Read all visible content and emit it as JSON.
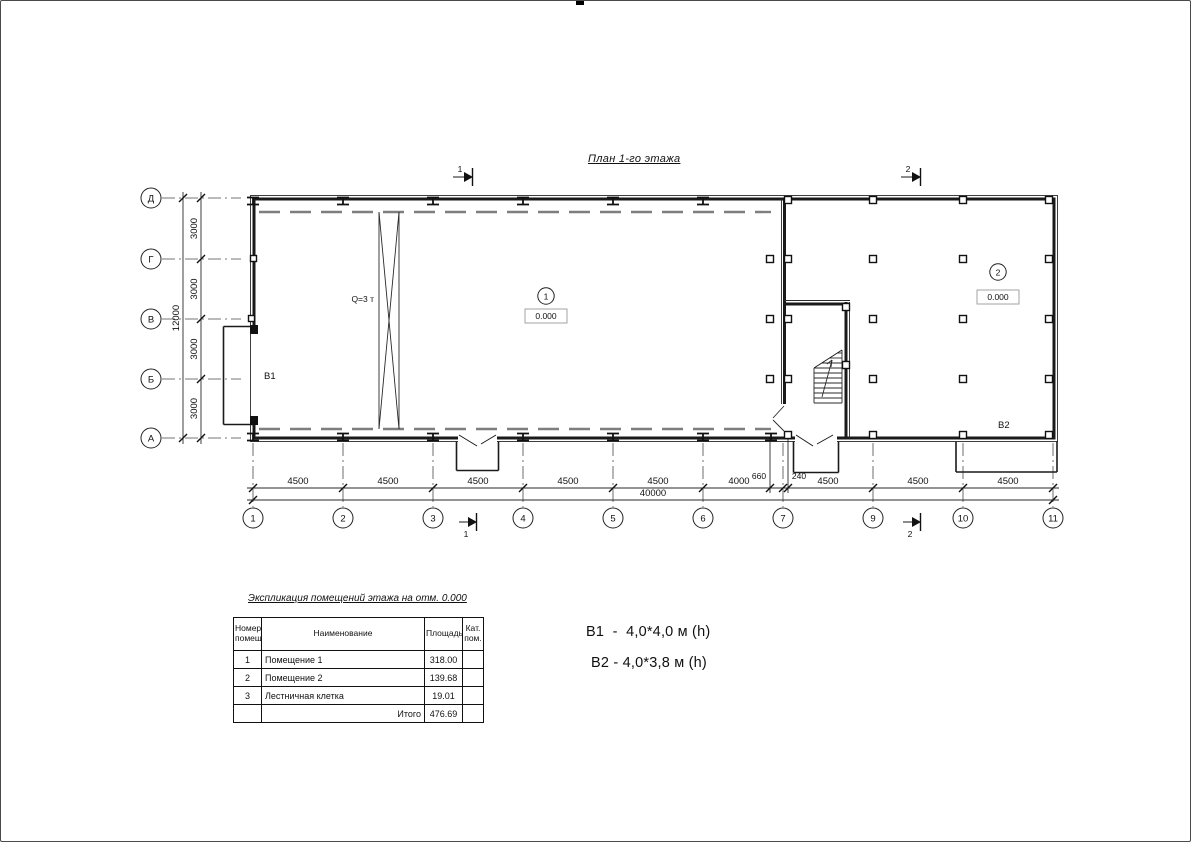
{
  "drawing": {
    "title": "План 1-го этажа",
    "crane_label": "Q=3 т",
    "axes_left": [
      "Д",
      "Г",
      "В",
      "Б",
      "А"
    ],
    "axes_bottom": [
      "1",
      "2",
      "3",
      "4",
      "5",
      "6",
      "7",
      "9",
      "10",
      "11"
    ],
    "dims": {
      "left_total": "12000",
      "left_segments": [
        "3000",
        "3000",
        "3000",
        "3000"
      ],
      "bottom_total": "40000",
      "bottom_segments": [
        "4500",
        "4500",
        "4500",
        "4500",
        "4500",
        "4000",
        "660",
        "240",
        "4500",
        "4500",
        "4500"
      ]
    },
    "sections": {
      "s1": "1",
      "s2": "2"
    },
    "room1": {
      "number": "1",
      "level": "0.000",
      "vent": "B1"
    },
    "room2": {
      "number": "2",
      "level": "0.000",
      "vent": "B2"
    }
  },
  "table": {
    "title": "Экспликация помещений этажа на отм. 0.000",
    "headers": {
      "num": "Номер\nпомещ.",
      "name": "Наименование",
      "area": "Площадь",
      "cat": "Кат.\nпом."
    },
    "rows": [
      {
        "num": "1",
        "name": "Помещение 1",
        "area": "318.00",
        "cat": ""
      },
      {
        "num": "2",
        "name": "Помещение 2",
        "area": "139.68",
        "cat": ""
      },
      {
        "num": "3",
        "name": "Лестничная клетка",
        "area": "19.01",
        "cat": ""
      }
    ],
    "total_label": "Итого",
    "total_value": "476.69"
  },
  "notes": {
    "b1": "B1  -  4,0*4,0 м (h)",
    "b2": "B2 - 4,0*3,8 м (h)"
  }
}
